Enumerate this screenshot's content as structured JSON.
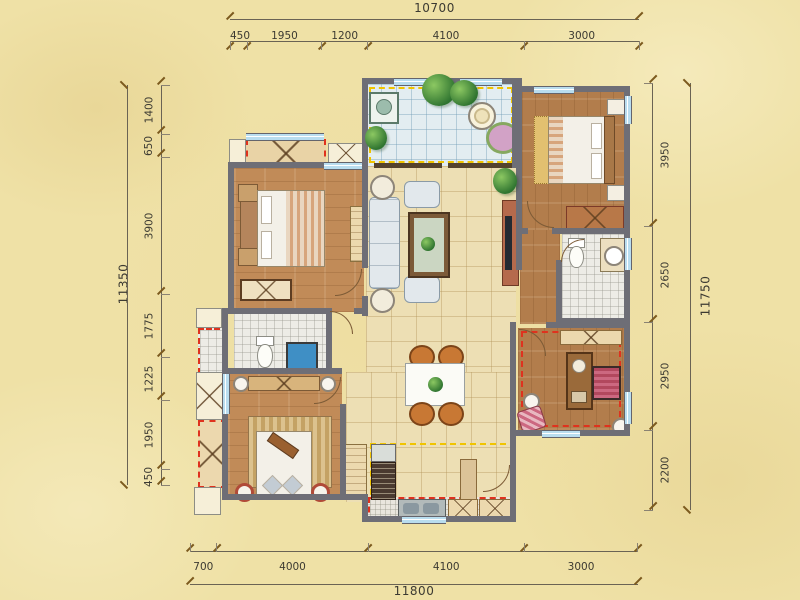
{
  "canvas": {
    "width": 800,
    "height": 600,
    "background": "#efe1a6"
  },
  "palette": {
    "wall": "#6e6e76",
    "wood_floor": "#c18b58",
    "hall_tile": "#eddfb4",
    "bath_tile": "#edece6",
    "balcony_tile": "#e3edf1",
    "window_blue": "#b9ddef",
    "accent_yellow": "#f0c400",
    "accent_red": "#df321e",
    "dimension_text": "#3c3a32",
    "dimension_line": "#6a6354"
  },
  "dimensions": {
    "top": {
      "total": "10700",
      "segments": [
        "450",
        "1950",
        "1200",
        "4100",
        "3000"
      ]
    },
    "bottom": {
      "total": "11800",
      "segments": [
        "700",
        "4000",
        "4100",
        "3000"
      ]
    },
    "left": {
      "total": "11350",
      "segments": [
        "1400",
        "650",
        "3900",
        "1775",
        "1225",
        "1950",
        "450"
      ]
    },
    "right": {
      "total": "11750",
      "segments": [
        "3950",
        "2650",
        "2950",
        "2200"
      ]
    }
  }
}
